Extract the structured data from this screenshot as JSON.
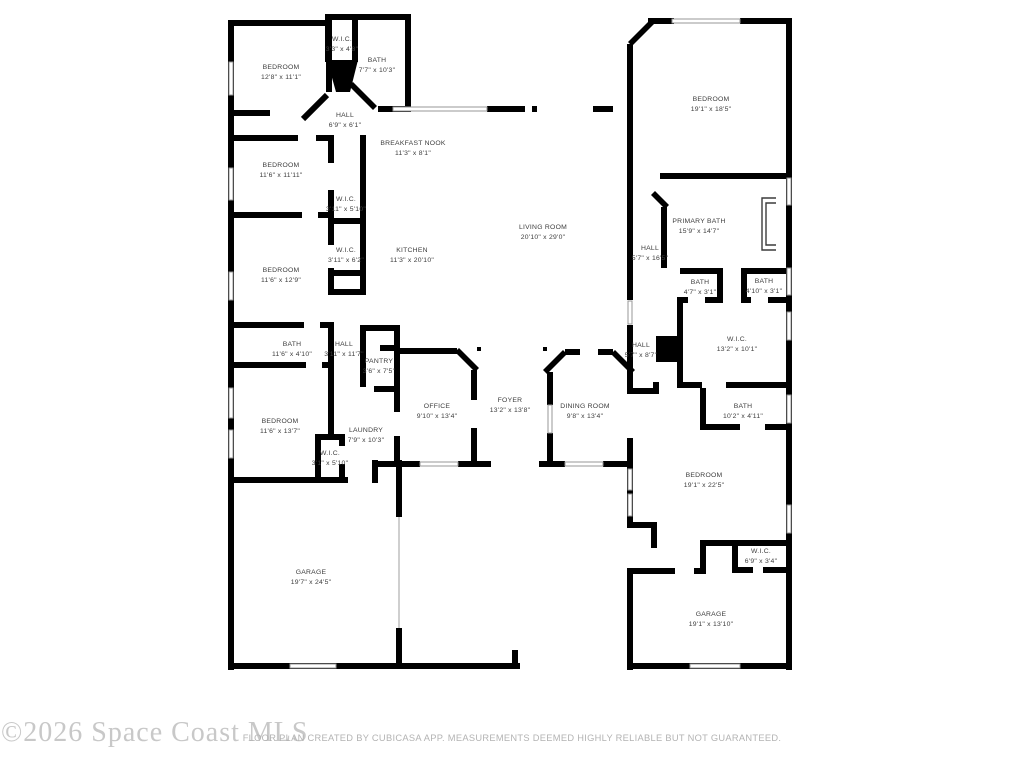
{
  "watermark": {
    "text": "©2026 Space Coast MLS",
    "color": "#c8c8c8"
  },
  "footer": {
    "disclaimer": "FLOOR PLAN CREATED BY CUBICASA APP. MEASUREMENTS DEEMED HIGHLY RELIABLE BUT NOT GUARANTEED.",
    "color": "#b3b3b3"
  },
  "plan": {
    "wall_color": "#000000",
    "window_color": "#979797",
    "label_color": "#3d3d3d",
    "rooms": [
      {
        "name": "BEDROOM",
        "dims": "12'8\" x 11'1\"",
        "cx": 281,
        "cy": 73
      },
      {
        "name": "W.I.C.",
        "dims": "3'3\" x 4'8\"",
        "cx": 342,
        "cy": 45
      },
      {
        "name": "BATH",
        "dims": "7'7\" x 10'3\"",
        "cx": 377,
        "cy": 66
      },
      {
        "name": "HALL",
        "dims": "6'9\" x 6'1\"",
        "cx": 345,
        "cy": 121
      },
      {
        "name": "BEDROOM",
        "dims": "11'6\" x 11'11\"",
        "cx": 281,
        "cy": 171
      },
      {
        "name": "W.I.C.",
        "dims": "3'11\" x 5'10\"",
        "cx": 346,
        "cy": 205
      },
      {
        "name": "W.I.C.",
        "dims": "3'11\" x 6'2\"",
        "cx": 346,
        "cy": 256
      },
      {
        "name": "BEDROOM",
        "dims": "11'6\" x 12'9\"",
        "cx": 281,
        "cy": 276
      },
      {
        "name": "BATH",
        "dims": "11'6\" x 4'10\"",
        "cx": 292,
        "cy": 350
      },
      {
        "name": "HALL",
        "dims": "3'11\" x 11'7\"",
        "cx": 344,
        "cy": 350
      },
      {
        "name": "PANTRY",
        "dims": "3'6\" x 7'5\"",
        "cx": 379,
        "cy": 367
      },
      {
        "name": "BEDROOM",
        "dims": "11'6\" x 13'7\"",
        "cx": 280,
        "cy": 427
      },
      {
        "name": "LAUNDRY",
        "dims": "7'9\" x 10'3\"",
        "cx": 366,
        "cy": 436
      },
      {
        "name": "W.I.C.",
        "dims": "3'1\" x 5'10\"",
        "cx": 330,
        "cy": 459
      },
      {
        "name": "BREAKFAST NOOK",
        "dims": "11'3\" x 8'1\"",
        "cx": 413,
        "cy": 149
      },
      {
        "name": "KITCHEN",
        "dims": "11'3\" x 20'10\"",
        "cx": 412,
        "cy": 256
      },
      {
        "name": "LIVING ROOM",
        "dims": "20'10\" x 29'0\"",
        "cx": 543,
        "cy": 233
      },
      {
        "name": "OFFICE",
        "dims": "9'10\" x 13'4\"",
        "cx": 437,
        "cy": 412
      },
      {
        "name": "FOYER",
        "dims": "13'2\" x 13'8\"",
        "cx": 510,
        "cy": 406
      },
      {
        "name": "DINING ROOM",
        "dims": "9'8\" x 13'4\"",
        "cx": 585,
        "cy": 412
      },
      {
        "name": "GARAGE",
        "dims": "19'7\" x 24'5\"",
        "cx": 311,
        "cy": 578
      },
      {
        "name": "BEDROOM",
        "dims": "19'1\" x 18'5\"",
        "cx": 711,
        "cy": 105
      },
      {
        "name": "PRIMARY BATH",
        "dims": "15'9\" x 14'7\"",
        "cx": 699,
        "cy": 227
      },
      {
        "name": "HALL",
        "dims": "5'7\" x 16'5\"",
        "cx": 650,
        "cy": 254
      },
      {
        "name": "BATH",
        "dims": "4'7\" x 3'1\"",
        "cx": 700,
        "cy": 288
      },
      {
        "name": "BATH",
        "dims": "4'10\" x 3'1\"",
        "cx": 764,
        "cy": 287
      },
      {
        "name": "W.I.C.",
        "dims": "13'2\" x 10'1\"",
        "cx": 737,
        "cy": 345
      },
      {
        "name": "HALL",
        "dims": "5'7\" x 8'7\"",
        "cx": 641,
        "cy": 351
      },
      {
        "name": "BATH",
        "dims": "10'2\" x 4'11\"",
        "cx": 743,
        "cy": 412
      },
      {
        "name": "BEDROOM",
        "dims": "19'1\" x 22'5\"",
        "cx": 704,
        "cy": 481
      },
      {
        "name": "W.I.C.",
        "dims": "6'9\" x 3'4\"",
        "cx": 761,
        "cy": 557
      },
      {
        "name": "GARAGE",
        "dims": "19'1\" x 13'10\"",
        "cx": 711,
        "cy": 620
      }
    ]
  }
}
